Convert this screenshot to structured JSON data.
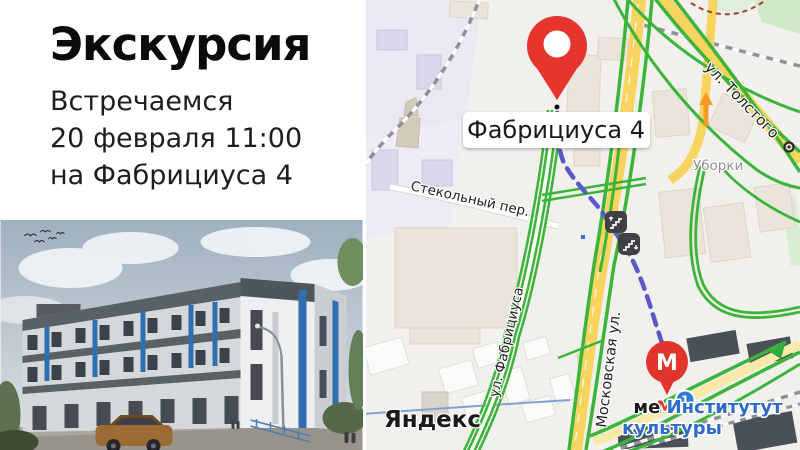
{
  "left_panel": {
    "title": "Экскурсия",
    "lines": [
      "Встречаемся",
      "20 февраля 11:00",
      "на Фабрициуса 4"
    ]
  },
  "map": {
    "pin_label": "Фабрициуса 4",
    "watermark": "Яндекс",
    "district_label": "Уборки",
    "streets": {
      "stekolny": "Стекольный пер.",
      "fabriciusa": "ул. Фабрициуса",
      "moskovskaya": "Московская ул.",
      "tolstogo": "ул. Толстого"
    },
    "metro": {
      "balloon_letter": "М",
      "logo_letter": "М",
      "line_badge": "1",
      "station_line1_black": "ме",
      "station_line1_blue": " Институтут",
      "station_line2": "культуры"
    },
    "colors": {
      "pin_red": "#e5352d",
      "route_purple": "#5b57c9",
      "traffic_green": "#3cb43a",
      "road_yellow": "#f6d45f",
      "metro_blue": "#2d7cd6"
    }
  }
}
